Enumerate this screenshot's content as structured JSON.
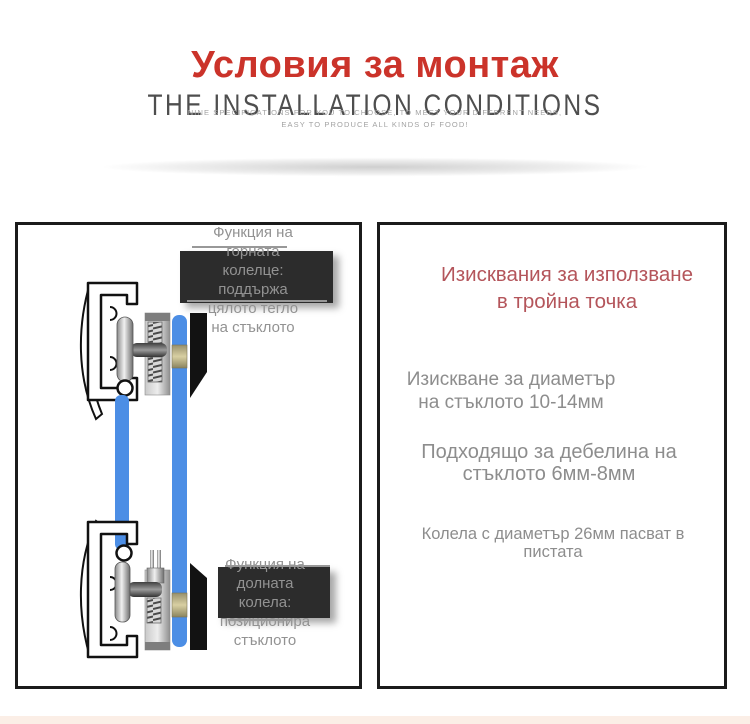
{
  "colors": {
    "title_red": "#cb332a",
    "panel_red": "#b4555b",
    "glass_blue": "#4c8ee5",
    "gasket_tan": "#cfc79c",
    "wedge_black": "#121212",
    "panel_border": "#1b1b1b",
    "label_gray": "#929292",
    "spec_gray": "#8d8d8d"
  },
  "header": {
    "title": "Условия за монтаж",
    "subtitle": "THE INSTALLATION CONDITIONS",
    "tagline1": "NINE SPECIFICATIONS FOR YOU TO CHOOSE, TO MEET YOUR DIFFERENT NEEDS,",
    "tagline2": "EASY TO PRODUCE ALL KINDS OF FOOD!"
  },
  "left_panel": {
    "top_label": [
      "Функция на",
      "горната",
      "колелце:",
      "поддържа",
      "цялото тегло",
      "на стъклото"
    ],
    "bottom_label": [
      "Функция на",
      "долната",
      "колела:",
      "позиционира",
      "стъклото"
    ]
  },
  "right_panel": {
    "title1": "Изисквания за използване",
    "title2": "в тройна точка",
    "specs": [
      {
        "l1": "Изискване за диаметър",
        "l2": "на стъклото 10-14мм"
      },
      {
        "l1": "Подходящо за дебелина на",
        "l2": "стъклото 6мм-8мм"
      },
      {
        "l1": "Колела с диаметър 26мм пасват в",
        "l2": "пистата"
      }
    ]
  }
}
